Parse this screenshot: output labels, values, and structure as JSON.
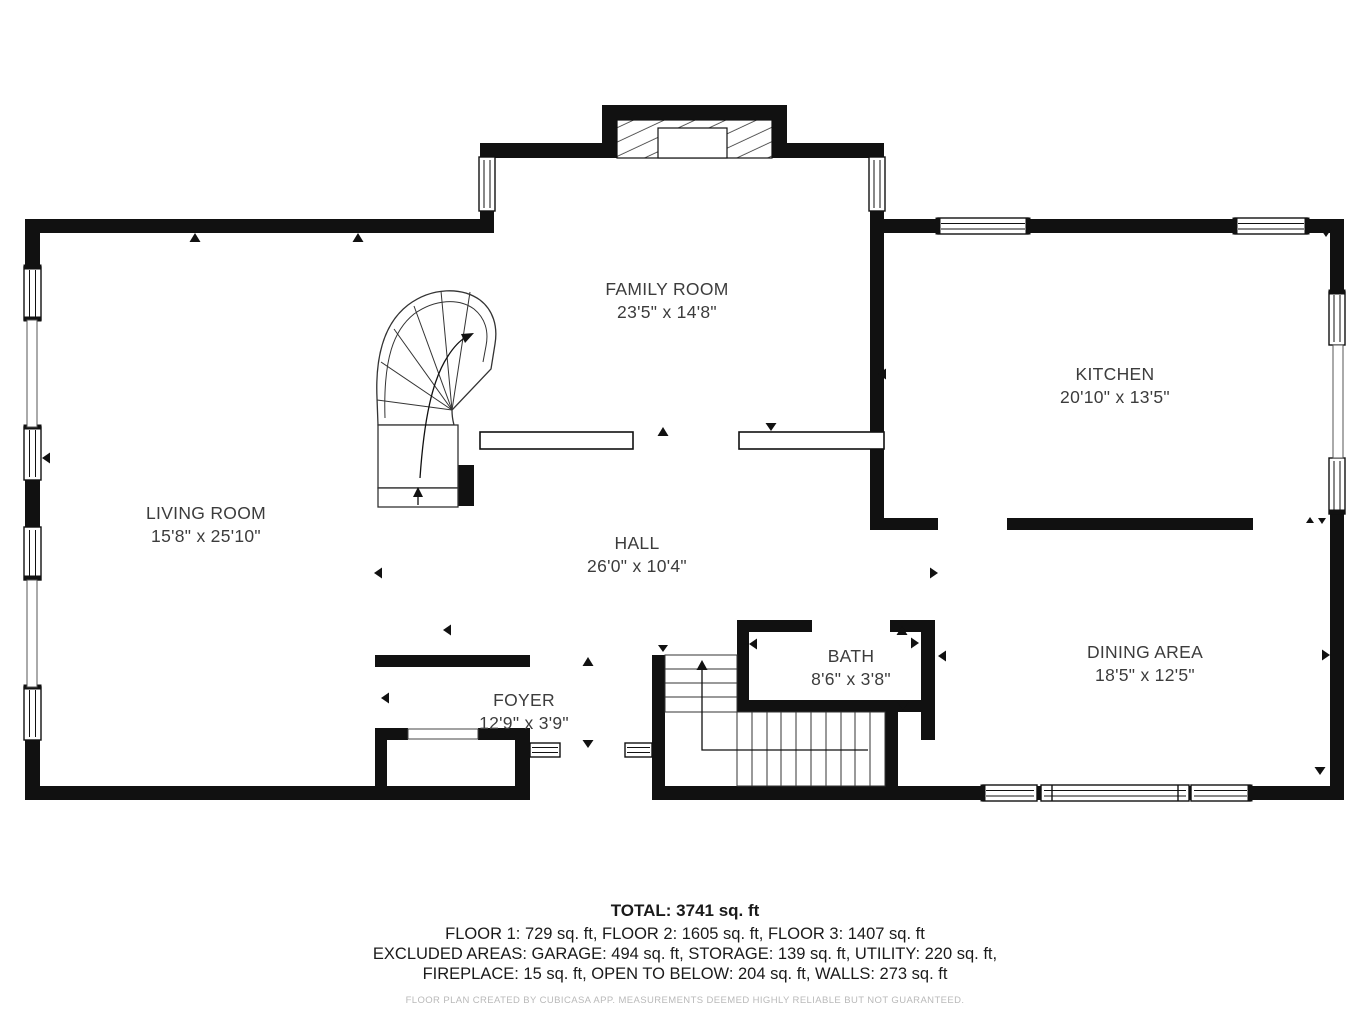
{
  "plan": {
    "rooms": [
      {
        "name": "FAMILY ROOM",
        "dims": "23'5\" x 14'8\""
      },
      {
        "name": "KITCHEN",
        "dims": "20'10\" x 13'5\""
      },
      {
        "name": "LIVING ROOM",
        "dims": "15'8\" x 25'10\""
      },
      {
        "name": "HALL",
        "dims": "26'0\" x 10'4\""
      },
      {
        "name": "BATH",
        "dims": "8'6\" x 3'8\""
      },
      {
        "name": "FOYER",
        "dims": "12'9\" x 3'9\""
      },
      {
        "name": "DINING AREA",
        "dims": "18'5\" x 12'5\""
      }
    ],
    "summary": {
      "total": "TOTAL: 3741 sq. ft",
      "floors": "FLOOR 1: 729 sq. ft, FLOOR 2: 1605 sq. ft, FLOOR 3: 1407 sq. ft",
      "excluded1": "EXCLUDED AREAS: GARAGE: 494 sq. ft, STORAGE: 139 sq. ft, UTILITY: 220 sq. ft,",
      "excluded2": "FIREPLACE: 15 sq. ft, OPEN TO BELOW: 204 sq. ft, WALLS: 273 sq. ft",
      "disclaimer": "FLOOR PLAN CREATED BY CUBICASA APP. MEASUREMENTS DEEMED HIGHLY RELIABLE BUT NOT GUARANTEED."
    },
    "colors": {
      "wall": "#111111",
      "background": "#ffffff",
      "label": "#3c3c3c"
    }
  }
}
